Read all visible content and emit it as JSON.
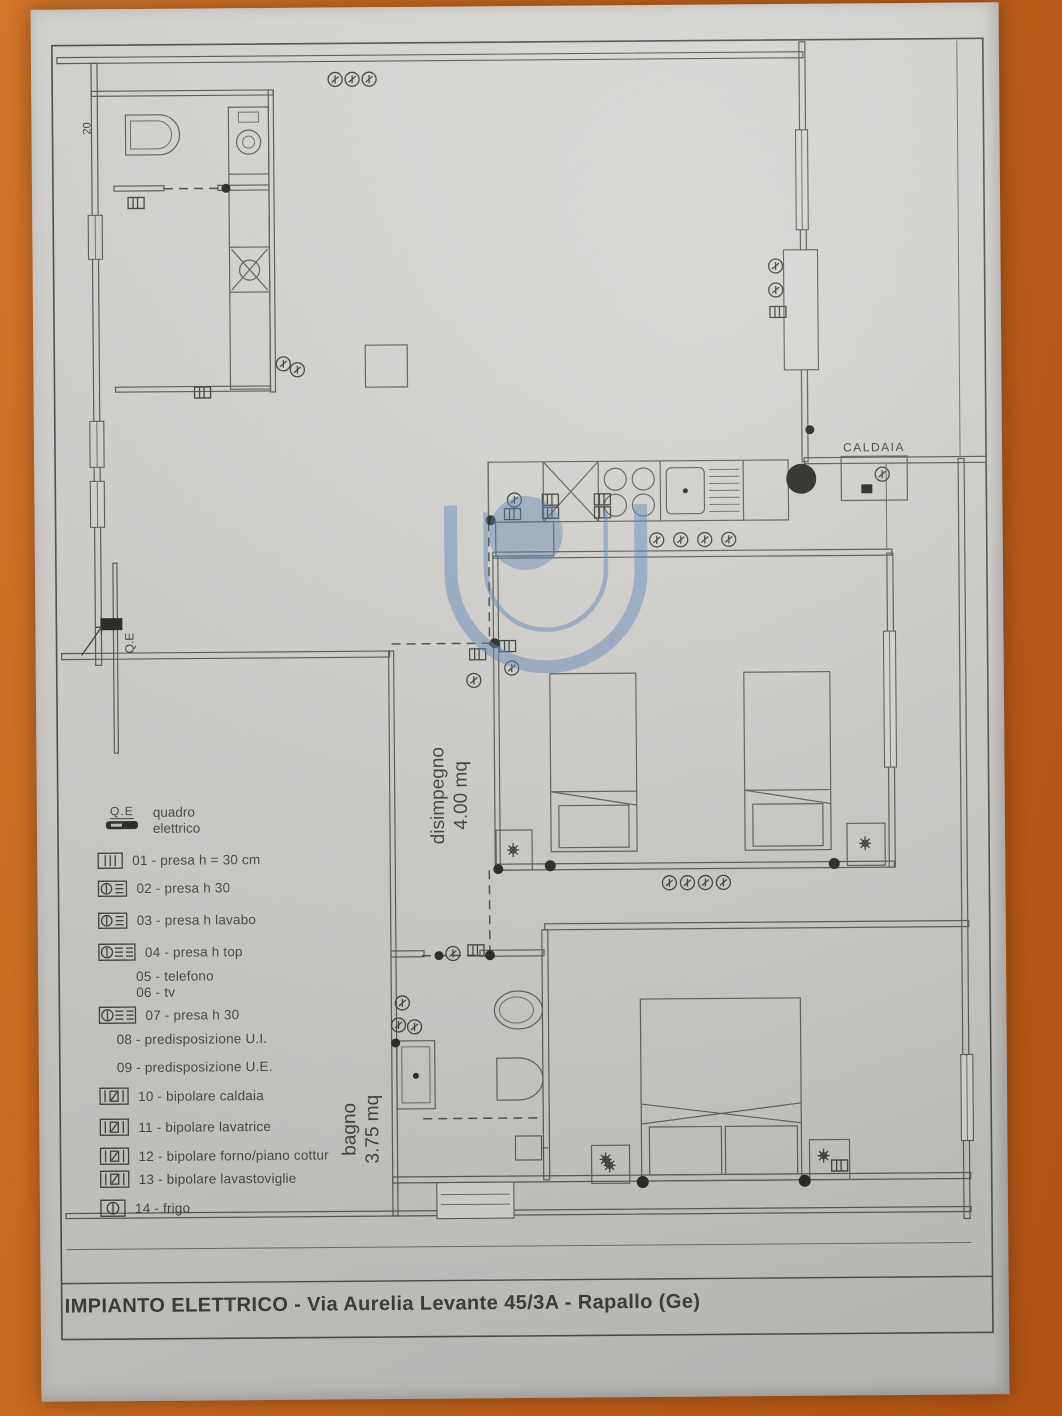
{
  "page": {
    "background_color": "#bf611c",
    "paper_color": "#d3d1ce"
  },
  "title_block": {
    "title": "IMPIANTO ELETTRICO - Via Aurelia Levante 45/3A - Rapallo (Ge)"
  },
  "plan_labels": {
    "caldaia": "CALDAIA",
    "electrical_panel": "Q.E",
    "dimension_top_left": "20",
    "hallway_name": "disimpegno",
    "hallway_area": "4.00 mq",
    "bathroom_name": "bagno",
    "bathroom_area": "3.75 mq"
  },
  "legend": {
    "panel": {
      "code": "Q.E",
      "label_line1": "quadro",
      "label_line2": "elettrico"
    },
    "items": [
      {
        "code": "01",
        "text": "01 - presa h = 30 cm",
        "icon": "socket-lines"
      },
      {
        "code": "02",
        "text": "02 - presa h 30",
        "icon": "socket-circle"
      },
      {
        "code": "03",
        "text": "03 - presa h lavabo",
        "icon": "socket-circle"
      },
      {
        "code": "04",
        "text": "04 - presa h top",
        "icon": "socket-wide"
      },
      {
        "code": "05",
        "text": "05 - telefono",
        "icon": "none"
      },
      {
        "code": "06",
        "text": "06 - tv",
        "icon": "none"
      },
      {
        "code": "07",
        "text": "07 - presa h 30",
        "icon": "socket-wide"
      },
      {
        "code": "08",
        "text": "08 - predisposizione U.I.",
        "icon": "none"
      },
      {
        "code": "09",
        "text": "09 - predisposizione U.E.",
        "icon": "none"
      },
      {
        "code": "10",
        "text": "10 - bipolare caldaia",
        "icon": "bipolar"
      },
      {
        "code": "11",
        "text": "11 - bipolare lavatrice",
        "icon": "bipolar"
      },
      {
        "code": "12",
        "text": "12 - bipolare forno/piano cottur",
        "icon": "bipolar"
      },
      {
        "code": "13",
        "text": "13 - bipolare lavastoviglie",
        "icon": "bipolar"
      },
      {
        "code": "14",
        "text": "14 - frigo",
        "icon": "frigo"
      }
    ]
  },
  "watermark": {
    "color": "#5c83b6"
  }
}
